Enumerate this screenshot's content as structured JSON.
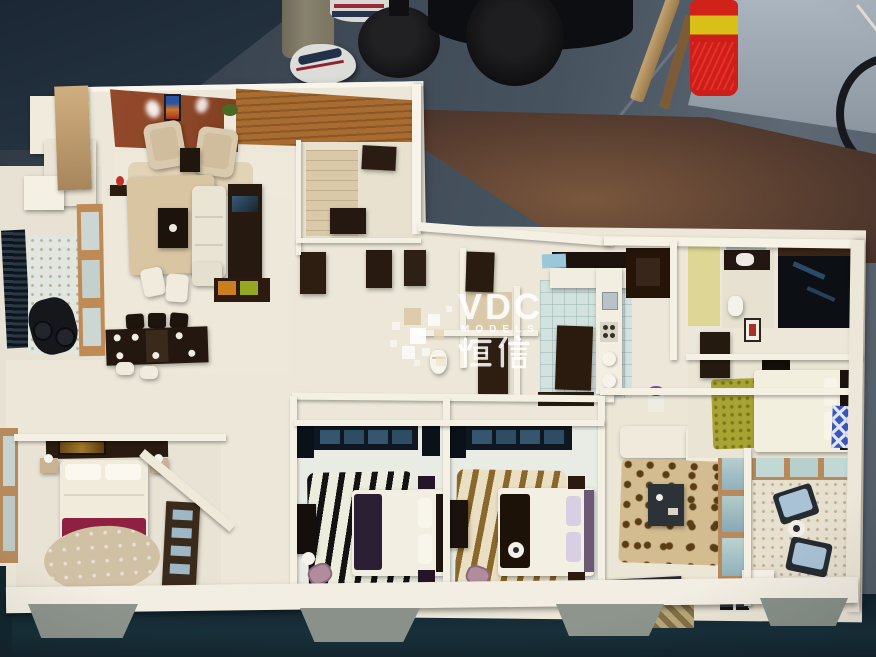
{
  "watermark": {
    "brand": "VDC",
    "subtitle": "MODELS",
    "chinese": "恒信"
  },
  "scene_objects": [
    "workshop-floor",
    "backdrop-wall",
    "person-leg",
    "sneaker",
    "stool-base",
    "duffel-bag",
    "wooden-stick",
    "fire-extinguisher",
    "power-cord",
    "bicycle-wheel",
    "display-table",
    "apartment-scale-model",
    "sitting-room",
    "living-room",
    "dining-table",
    "balcony",
    "kitchen",
    "bathroom",
    "master-bedroom",
    "zebra-rug-bedroom",
    "brown-zebra-bedroom",
    "green-rug-bedroom",
    "family-room",
    "sunroom",
    "watermark"
  ],
  "palette": {
    "bg_floor": "#46525e",
    "bg_floor_dark": "#2e3945",
    "bg_navy": "#1b2734",
    "wall_backdrop": "#9aa4ae",
    "table_wood": "#54392a",
    "table_wood_light": "#7a573e",
    "model_cream": "#ece7d8",
    "model_white": "#f4f0e4",
    "rust_wall": "#8c4628",
    "wood_slat": "#a86c32",
    "dark_wood": "#261a10",
    "rug_beige": "#dac5a3",
    "tile_blue": "#d2e2de",
    "maroon": "#8e2142",
    "green_rug": "#a9a432",
    "leopard_base": "#d2bc90",
    "zebra_brown": "#8a672a",
    "teal_shadow": "#13262f",
    "extinguisher_red": "#cc1f1a",
    "khaki": "#88826e"
  }
}
